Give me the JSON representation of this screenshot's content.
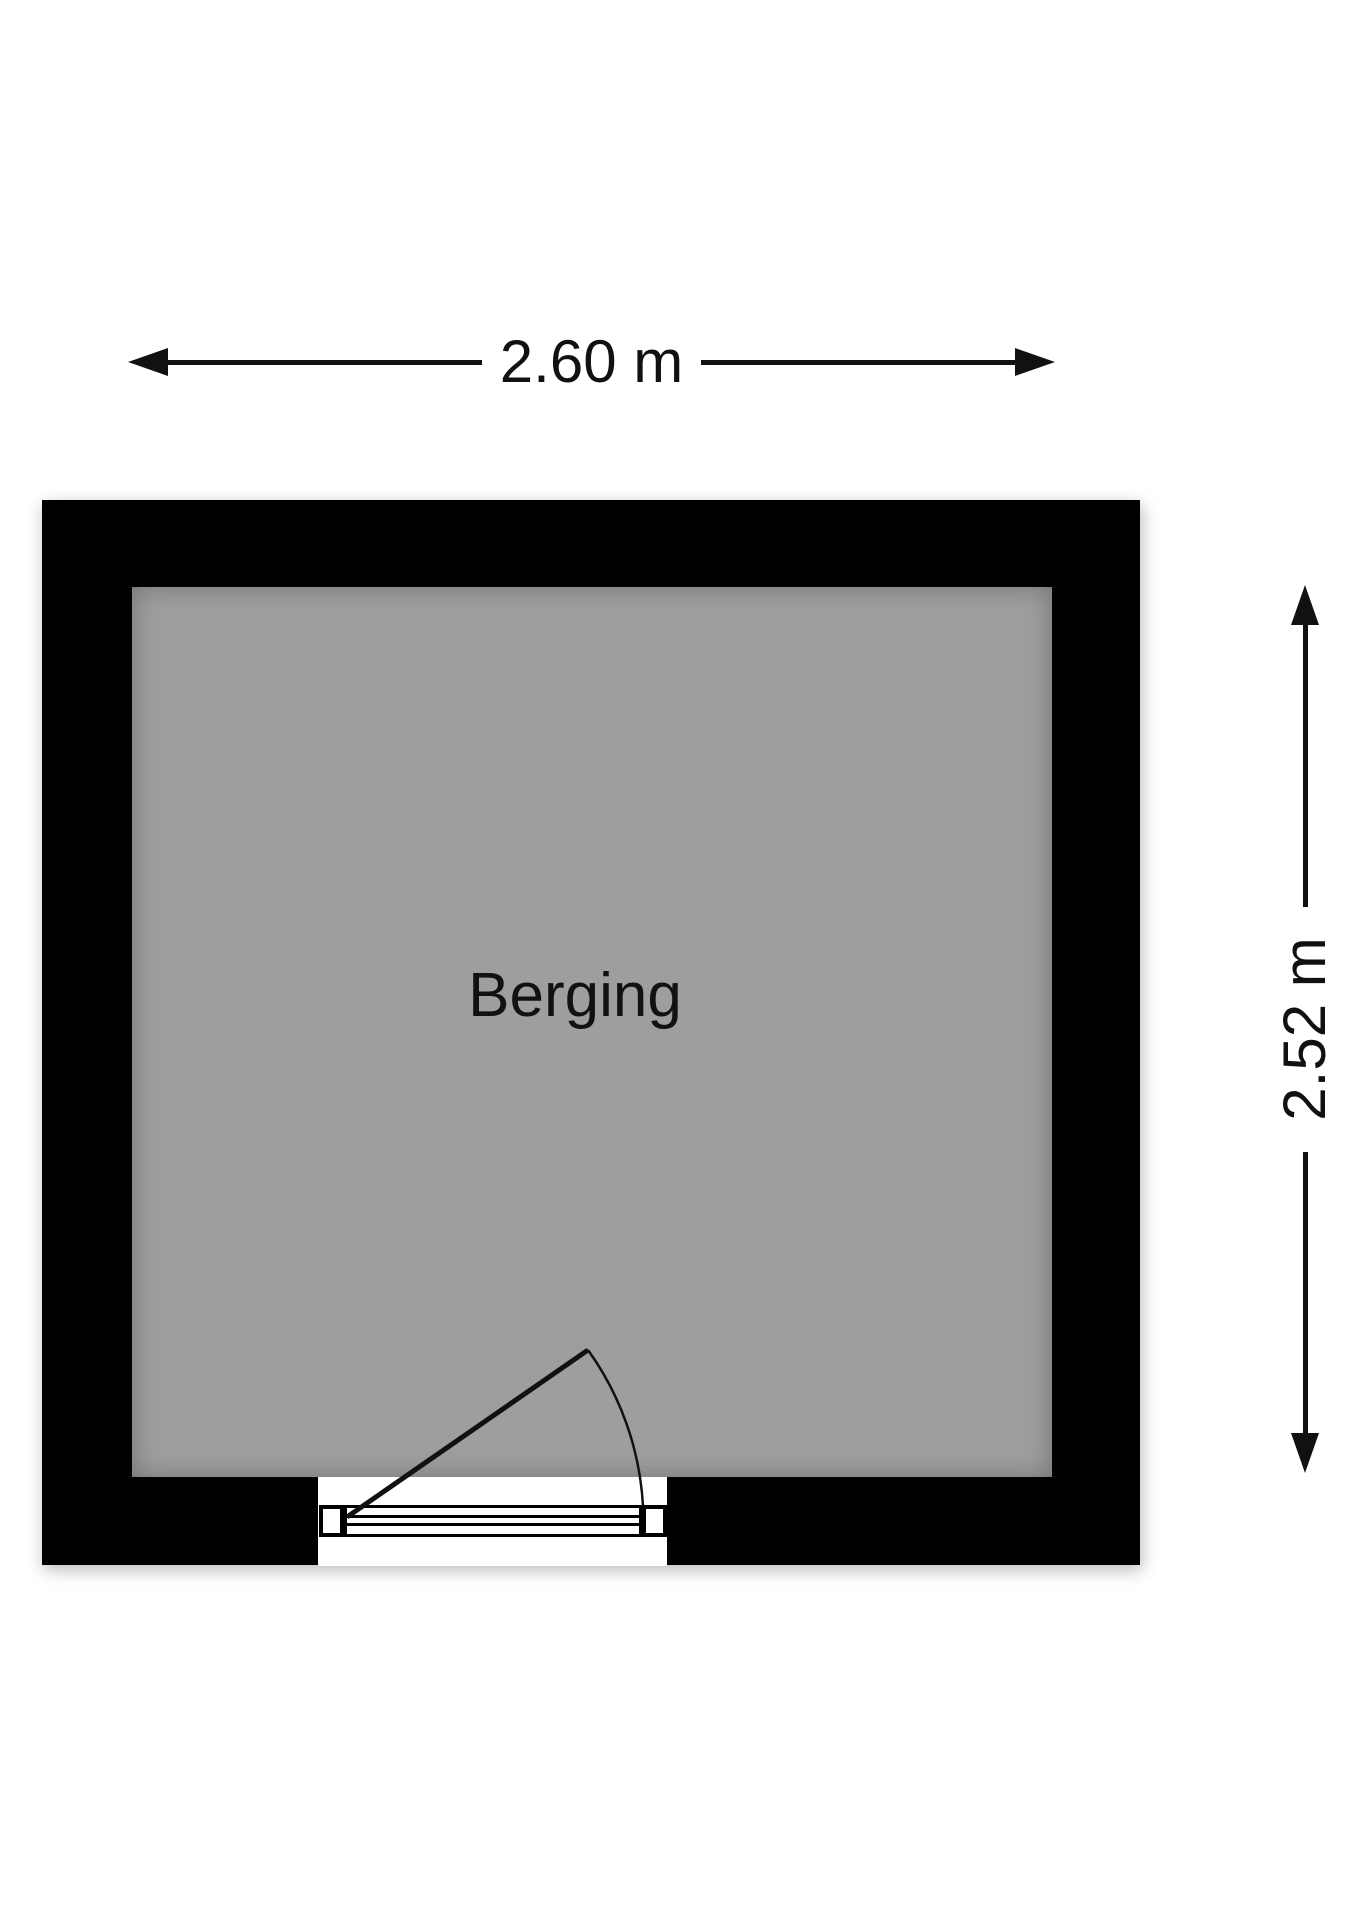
{
  "floorplan": {
    "room": {
      "label": "Berging"
    },
    "dimensions": {
      "width_label": "2.60 m",
      "height_label": "2.52 m"
    }
  },
  "colors": {
    "wall": "#000000",
    "floor": "#9e9e9e",
    "line": "#111111",
    "background": "#ffffff"
  }
}
